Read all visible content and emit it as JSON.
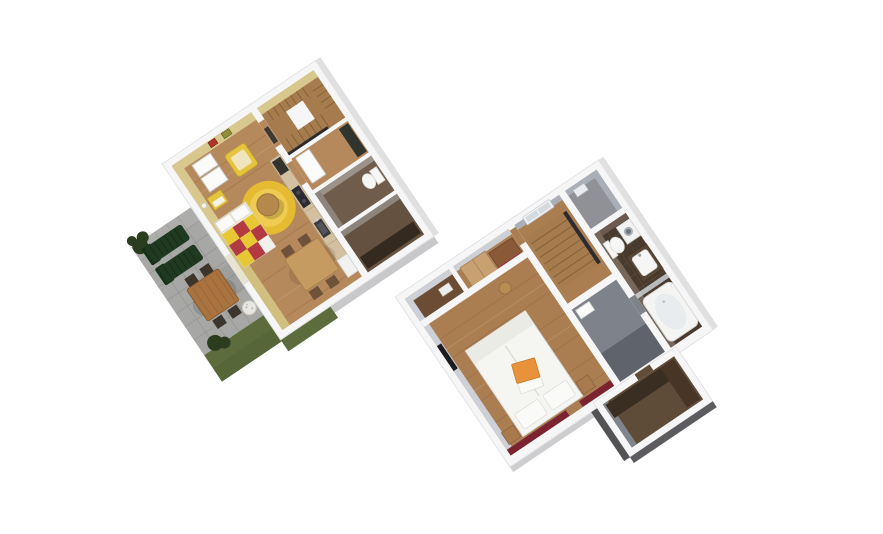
{
  "scene": {
    "description": "3D isometric architectural rendering of a two-storey apartment shown as two rotated cut-away floor plans on a white background",
    "floors": [
      {
        "name": "ground-floor",
        "position": "upper-left",
        "rooms": [
          "living-dining-room",
          "kitchen-corner",
          "staircase",
          "hallway",
          "wc",
          "storage-room",
          "terrace",
          "garden-lawn"
        ],
        "wall_finish": "yellow painted walls, white wall tops",
        "furniture": [
          "white-wardrobe",
          "yellow-side-cabinet",
          "yellow-armchair",
          "round-yellow-rug",
          "round-coffee-table",
          "checkered-red-yellow-sofa-bed",
          "dining-table-with-four-chairs",
          "kitchen-counter-with-cooktop-sink-fridge",
          "framed-pictures",
          "wall-lamp",
          "coat-stand",
          "toilet",
          "storage-shelf",
          "two-green-sun-loungers",
          "wooden-garden-table-with-chairs",
          "planter-pot",
          "shrubs"
        ]
      },
      {
        "name": "upper-floor",
        "position": "lower-right",
        "rooms": [
          "bedroom",
          "landing-with-stairs",
          "closet-room",
          "corridor",
          "bathroom",
          "dressing-room"
        ],
        "wall_finish": "grey walls, dark red accent wall behind bed, dark tiled bathroom",
        "furniture": [
          "double-bed-white",
          "orange-accent-pillow",
          "two-nightstands",
          "wardrobe",
          "dresser-with-red-front",
          "round-stool",
          "tv-niche",
          "window",
          "wall-mirror",
          "toilet",
          "vanity-sink",
          "washing-machine",
          "glass-divider",
          "bathtub",
          "dressing-cabinets"
        ]
      }
    ]
  },
  "colors": {
    "background": "#ffffff",
    "wall_white": "#f6f6f7",
    "outline": "#e3e3e6",
    "wood1": "#b5895c",
    "wood_streak": "#7a4f28",
    "wall_yellow": "#d8c88e",
    "wall_yellow_deep": "#cdb975",
    "picture_red": "#b03328",
    "picture_olive": "#8f8f3a",
    "lamp": "#f6f4ea",
    "wardrobe_white": "#fbfbfa",
    "armchair": "#e6c53e",
    "armchair_seat": "#f0e5bd",
    "rug": "#e5bb31",
    "rug_inner": "#efcb51",
    "round_table": "#b5884b",
    "sofa_base": "#efe9d8",
    "sofa_red": "#b23b43",
    "sofa_yellow": "#e7c834",
    "dine_table": "#c59b61",
    "chair_dark": "#6e523a",
    "counter": "#d3c0a0",
    "appliance": "#2c2c30",
    "fridge": "#f1f1ef",
    "stair_wood": "#a67c4e",
    "stair_line": "#7c5a33",
    "hall_cabinet": "#30342f",
    "wc_floor": "#6f5c4a",
    "storage_floor": "#64513f",
    "shelf_dark": "#342a20",
    "fixture": "#f6f6f4",
    "fixture_line": "#d7d7d3",
    "terrace": "#a7a7a5",
    "terrace_line": "#8f8f8b",
    "grass": "#5c6c3c",
    "grass_dark": "#515f34",
    "plant": "#2a3d1f",
    "lounger": "#1f3a20",
    "lounger_back": "#16301a",
    "garden_table": "#a9733f",
    "garden_chair": "#3b352b",
    "pot": "#e9e7e1",
    "wood2": "#ab7e52",
    "wall_gray_light": "#cdd0d6",
    "wall_gray": "#a9aeb7",
    "wall_gray_dark": "#868c98",
    "maroon": "#7c2330",
    "annex_floor": "#6b4c34",
    "closet_floor": "#8f9196",
    "corridor_floor": "#7e828a",
    "corridor_dark": "#5f636b",
    "bath_floor": "#483a2e",
    "bath_line": "#5d4a3b",
    "bath_wall": "#6b5a4d",
    "bath_wall2": "#77665a",
    "vanity": "#574635",
    "washer_door": "#a8aeb4",
    "glass": "#ccd2d6",
    "window_pane": "#d5dade",
    "bed": "#f5f5f2",
    "bed_fold": "#ebebe6",
    "pillow": "#fafaf8",
    "orange": "#e8923b",
    "tan": "#c8a172",
    "nightstand": "#a87a4e",
    "brown_mid": "#8a5a38",
    "red_front": "#9c3038",
    "stool": "#b88c52",
    "tv": "#1d1d21",
    "south_floor": "#5f4c38",
    "dark_furn": "#3a2d22",
    "dark_furn2": "#473628",
    "rail_dark": "#2c2c30",
    "shadow_dark": "#404044",
    "shadow_mid": "#9b9b9f",
    "shadow_light": "#d8d8da"
  }
}
